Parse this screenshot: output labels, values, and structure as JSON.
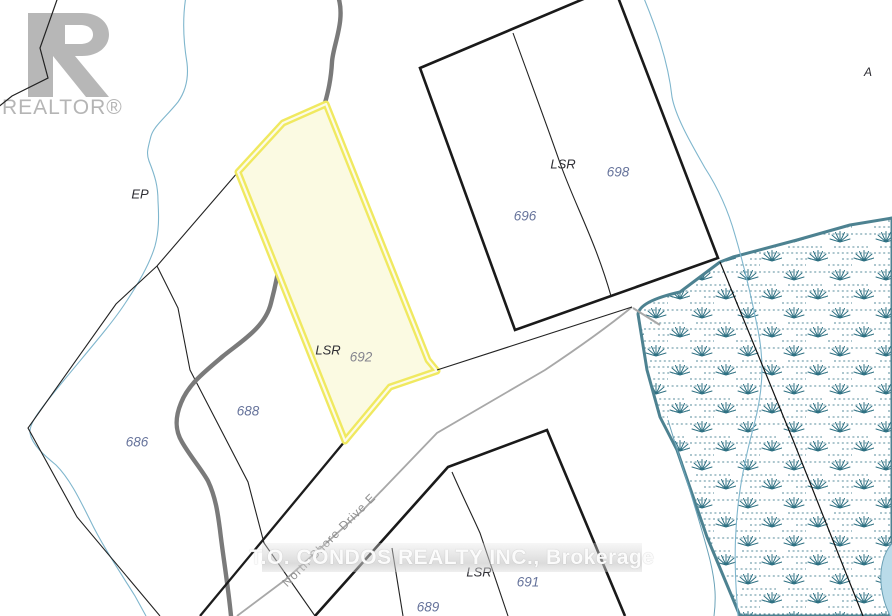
{
  "branding": {
    "realtor_logo": "REALTOR®",
    "brokerage_watermark": "T.O. CONDOS REALTY INC., Brokerage"
  },
  "road": {
    "name": "North Shore Drive E"
  },
  "zones": {
    "ep": "EP",
    "a": "A",
    "lsr_upper": "LSR",
    "lsr_lower": "LSR"
  },
  "parcels": {
    "highlighted": {
      "number": "692",
      "zone": "LSR"
    },
    "numbers": {
      "n686": "686",
      "n688": "688",
      "n689": "689",
      "n691": "691",
      "n696": "696",
      "n698": "698"
    }
  },
  "colors": {
    "highlight_border": "#f0e960",
    "highlight_fill": "#fbfae2",
    "wetland_line": "#4d8291",
    "wetland_symbol": "#2f7183",
    "stream": "#7fb6cd",
    "pond_fill": "#b9dbe9",
    "boundary": "#1a1a1a",
    "road_line": "#a8a8a8",
    "trail": "#7a7a7a",
    "parcel_number_text": "#66739b",
    "zone_text": "#2e2e34"
  }
}
